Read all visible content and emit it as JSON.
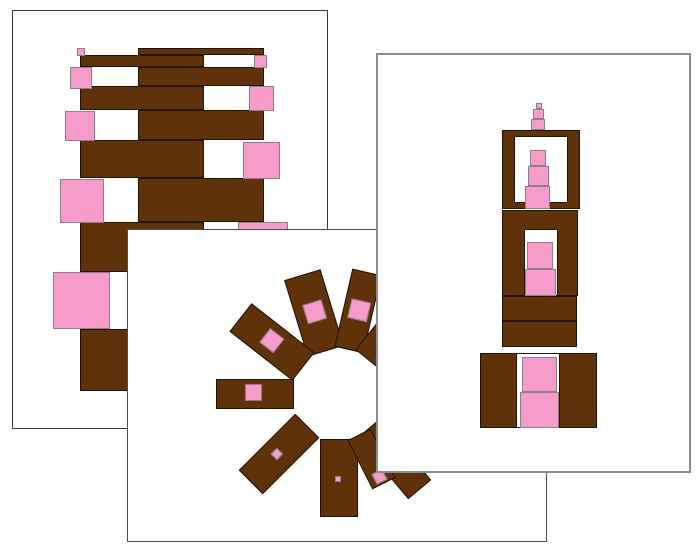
{
  "canvas": {
    "width": 700,
    "height": 552,
    "background": "#ffffff"
  },
  "colors": {
    "brown": "#5f3209",
    "brown_outline": "#241303",
    "pink": "#f79bcb",
    "pink_outline": "#8f7d88",
    "white": "#ffffff"
  },
  "cards": [
    {
      "name": "brown-stair-zigzag-card",
      "x": 12,
      "y": 10,
      "width": 316,
      "height": 419,
      "z": 1,
      "border_color": "#3a3a3a",
      "border_width": 1.5,
      "rects": [
        {
          "fill": "brown",
          "x": 125,
          "y": 37,
          "w": 126,
          "h": 7
        },
        {
          "fill": "brown",
          "x": 67,
          "y": 44,
          "w": 124,
          "h": 12
        },
        {
          "fill": "brown",
          "x": 125,
          "y": 56,
          "w": 126,
          "h": 19
        },
        {
          "fill": "brown",
          "x": 67,
          "y": 75,
          "w": 124,
          "h": 24
        },
        {
          "fill": "brown",
          "x": 125,
          "y": 99,
          "w": 126,
          "h": 30
        },
        {
          "fill": "brown",
          "x": 67,
          "y": 129,
          "w": 124,
          "h": 38
        },
        {
          "fill": "brown",
          "x": 125,
          "y": 167,
          "w": 126,
          "h": 44
        },
        {
          "fill": "brown",
          "x": 67,
          "y": 211,
          "w": 124,
          "h": 50
        },
        {
          "fill": "brown",
          "x": 125,
          "y": 261,
          "w": 126,
          "h": 57
        },
        {
          "fill": "brown",
          "x": 67,
          "y": 318,
          "w": 124,
          "h": 62
        },
        {
          "fill": "pink",
          "x": 64,
          "y": 37,
          "w": 8,
          "h": 8
        },
        {
          "fill": "pink",
          "x": 241,
          "y": 44,
          "w": 13,
          "h": 13
        },
        {
          "fill": "pink",
          "x": 57,
          "y": 56,
          "w": 22,
          "h": 22
        },
        {
          "fill": "pink",
          "x": 236,
          "y": 75,
          "w": 25,
          "h": 25
        },
        {
          "fill": "pink",
          "x": 52,
          "y": 100,
          "w": 30,
          "h": 30
        },
        {
          "fill": "pink",
          "x": 230,
          "y": 131,
          "w": 37,
          "h": 37
        },
        {
          "fill": "pink",
          "x": 47,
          "y": 168,
          "w": 44,
          "h": 44
        },
        {
          "fill": "pink",
          "x": 225,
          "y": 211,
          "w": 50,
          "h": 50
        },
        {
          "fill": "pink",
          "x": 40,
          "y": 261,
          "w": 57,
          "h": 57
        },
        {
          "fill": "pink",
          "x": 220,
          "y": 318,
          "w": 62,
          "h": 62
        }
      ]
    },
    {
      "name": "radial-sunburst-card",
      "x": 127,
      "y": 229,
      "width": 420,
      "height": 313,
      "z": 2,
      "border_color": "#4d4d4d",
      "border_width": 1.5,
      "rays": {
        "center_x": 211,
        "center_y": 164,
        "inner_radius": 45,
        "items": [
          {
            "angle": 107,
            "len": 80,
            "width": 38,
            "pink": 20,
            "pink_offset": 0
          },
          {
            "angle": 77,
            "len": 80,
            "width": 30,
            "pink": 20,
            "pink_offset": 0
          },
          {
            "angle": 142,
            "len": 80,
            "width": 36,
            "pink": 18,
            "pink_offset": 0
          },
          {
            "angle": 180,
            "len": 78,
            "width": 30,
            "pink": 17,
            "pink_offset": 0
          },
          {
            "angle": 225,
            "len": 80,
            "width": 34,
            "pink": 9,
            "pink_offset": 0
          },
          {
            "angle": 270,
            "len": 78,
            "width": 38,
            "pink": 6,
            "pink_offset": 0
          },
          {
            "angle": 51,
            "len": 80,
            "width": 30,
            "pink": 14,
            "pink_offset": 0
          },
          {
            "angle": 15,
            "len": 80,
            "width": 32,
            "pink": 12,
            "pink_offset": 0
          },
          {
            "angle": 310,
            "len": 80,
            "width": 30,
            "pink": 14,
            "pink_offset": 0
          },
          {
            "angle": 297,
            "len": 55,
            "width": 26,
            "pink": 12,
            "pink_offset": 18
          }
        ]
      }
    },
    {
      "name": "pink-tower-stack-card",
      "x": 376,
      "y": 53,
      "width": 315,
      "height": 420,
      "z": 3,
      "border_color": "#8d8d8d",
      "border_width": 2,
      "rects": [
        {
          "fill": "pink",
          "x": 158,
          "y": 48,
          "w": 6,
          "h": 6
        },
        {
          "fill": "pink",
          "x": 155,
          "y": 54,
          "w": 11,
          "h": 10
        },
        {
          "fill": "pink",
          "x": 153,
          "y": 64,
          "w": 14,
          "h": 11
        },
        {
          "fill": "brown",
          "x": 124,
          "y": 75,
          "w": 78,
          "h": 79
        },
        {
          "fill": "white",
          "x": 136,
          "y": 81,
          "w": 54,
          "h": 67
        },
        {
          "fill": "pink",
          "x": 152,
          "y": 95,
          "w": 16,
          "h": 16
        },
        {
          "fill": "pink",
          "x": 150,
          "y": 111,
          "w": 21,
          "h": 20
        },
        {
          "fill": "pink",
          "x": 147,
          "y": 131,
          "w": 25,
          "h": 23
        },
        {
          "fill": "brown",
          "x": 124,
          "y": 155,
          "w": 76,
          "h": 86
        },
        {
          "fill": "white",
          "x": 146,
          "y": 174,
          "w": 34,
          "h": 67
        },
        {
          "fill": "pink",
          "x": 149,
          "y": 187,
          "w": 26,
          "h": 27
        },
        {
          "fill": "pink",
          "x": 147,
          "y": 214,
          "w": 31,
          "h": 27
        },
        {
          "fill": "brown",
          "x": 124,
          "y": 241,
          "w": 75,
          "h": 25
        },
        {
          "fill": "brown",
          "x": 124,
          "y": 266,
          "w": 75,
          "h": 26
        },
        {
          "fill": "brown",
          "x": 102,
          "y": 298,
          "w": 117,
          "h": 75
        },
        {
          "fill": "white",
          "x": 138,
          "y": 298,
          "w": 44,
          "h": 75
        },
        {
          "fill": "pink",
          "x": 144,
          "y": 302,
          "w": 35,
          "h": 35
        },
        {
          "fill": "pink",
          "x": 142,
          "y": 337,
          "w": 39,
          "h": 36
        }
      ]
    }
  ]
}
